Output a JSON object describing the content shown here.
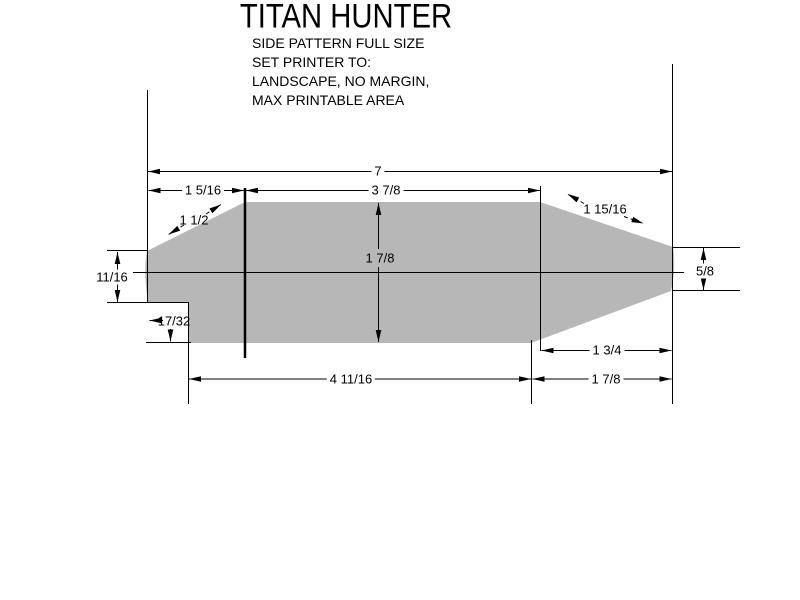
{
  "title": "TITAN HUNTER",
  "subtitle_lines": [
    "SIDE PATTERN FULL SIZE",
    "SET PRINTER TO:",
    "LANDSCAPE, NO MARGIN,",
    "MAX PRINTABLE AREA"
  ],
  "dimensions": {
    "overall_length": "7",
    "nose_section_length": "1 5/16",
    "top_flat_length": "3 7/8",
    "nose_slope_length": "1 1/2",
    "tail_slope_length": "1 15/16",
    "nose_height": "11/16",
    "body_height": "1 7/8",
    "tail_height": "5/8",
    "notch_height": "17/32",
    "tail_slope_run": "1 3/4",
    "tail_section_length": "1 7/8",
    "body_bottom_length": "4 11/16"
  },
  "colors": {
    "background": "#ffffff",
    "shape_fill": "#b7b7b7",
    "dimension_line": "#000000",
    "section_line": "#636363"
  }
}
